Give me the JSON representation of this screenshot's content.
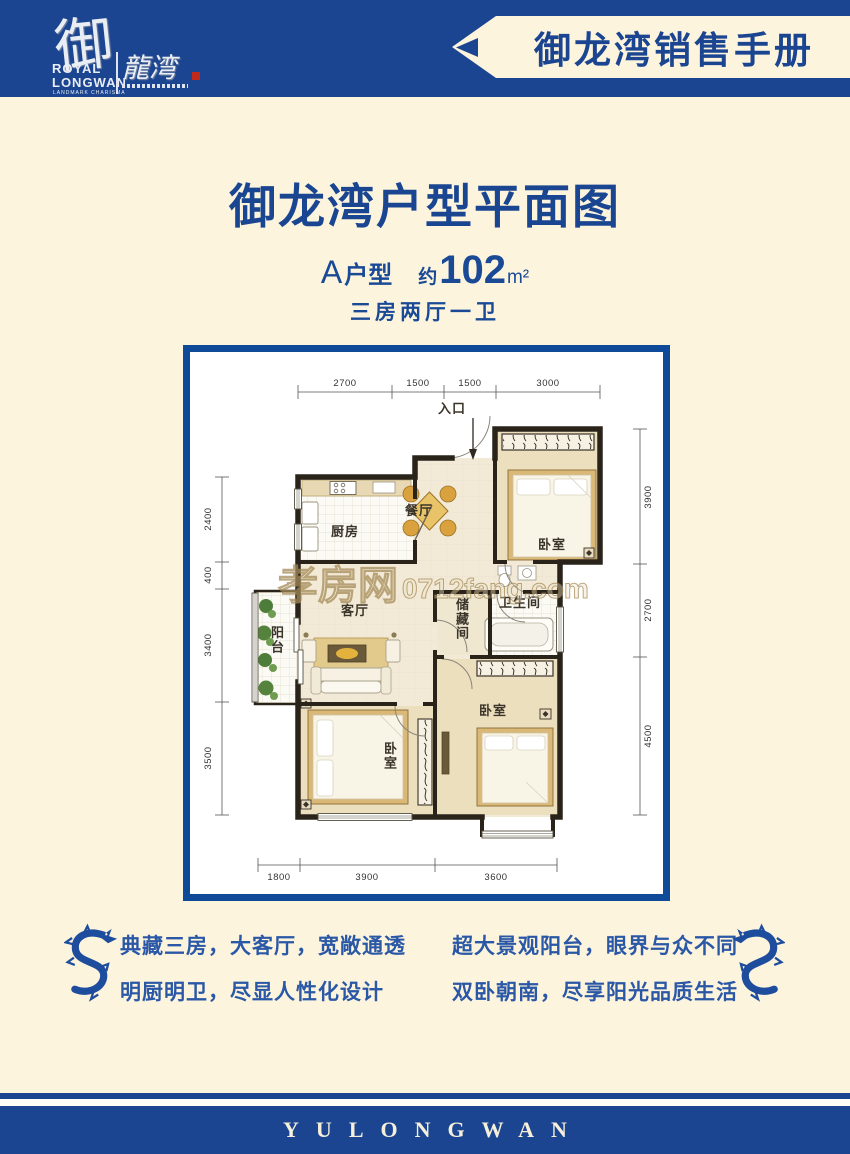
{
  "colors": {
    "navy": "#1b4591",
    "title_blue": "#1a4a96",
    "cream": "#fdf4de",
    "wall": "#2a231a",
    "accent": "#d9a23e",
    "seal_red": "#c2291d"
  },
  "header": {
    "banner_title": "御龙湾销售手册",
    "logo": {
      "glyph": "御",
      "script": "龍湾",
      "line1": "ROYAL",
      "line2": "LONGWAN",
      "tagline": "LANDMARK CHARISMA"
    }
  },
  "intro": {
    "title": "御龙湾户型平面图",
    "unit_prefix": "A",
    "unit_suffix": "户型",
    "approx": "约",
    "area": "102",
    "area_unit": "m²",
    "layout": "三房两厅一卫"
  },
  "floorplan": {
    "watermark_cn": "孝房网",
    "watermark_en": "0712fang.com",
    "entrance": "入口",
    "rooms": {
      "dining": "餐厅",
      "kitchen": "厨房",
      "bedroom": "卧室",
      "living": "客厅",
      "bath": "卫生间",
      "storage": "储藏间",
      "balcony": "阳台"
    },
    "dims": {
      "top": [
        "2700",
        "1500",
        "1500",
        "3000"
      ],
      "left": [
        "2400",
        "400",
        "3400",
        "3500"
      ],
      "right": [
        "3900",
        "2700",
        "4500"
      ],
      "bottom": [
        "1800",
        "3900",
        "3600"
      ]
    }
  },
  "features": {
    "left": [
      "典藏三房，大客厅，宽敞通透",
      "明厨明卫，尽显人性化设计"
    ],
    "right": [
      "超大景观阳台，眼界与众不同",
      "双卧朝南，尽享阳光品质生活"
    ]
  },
  "footer": {
    "brand": "YULONGWAN"
  }
}
